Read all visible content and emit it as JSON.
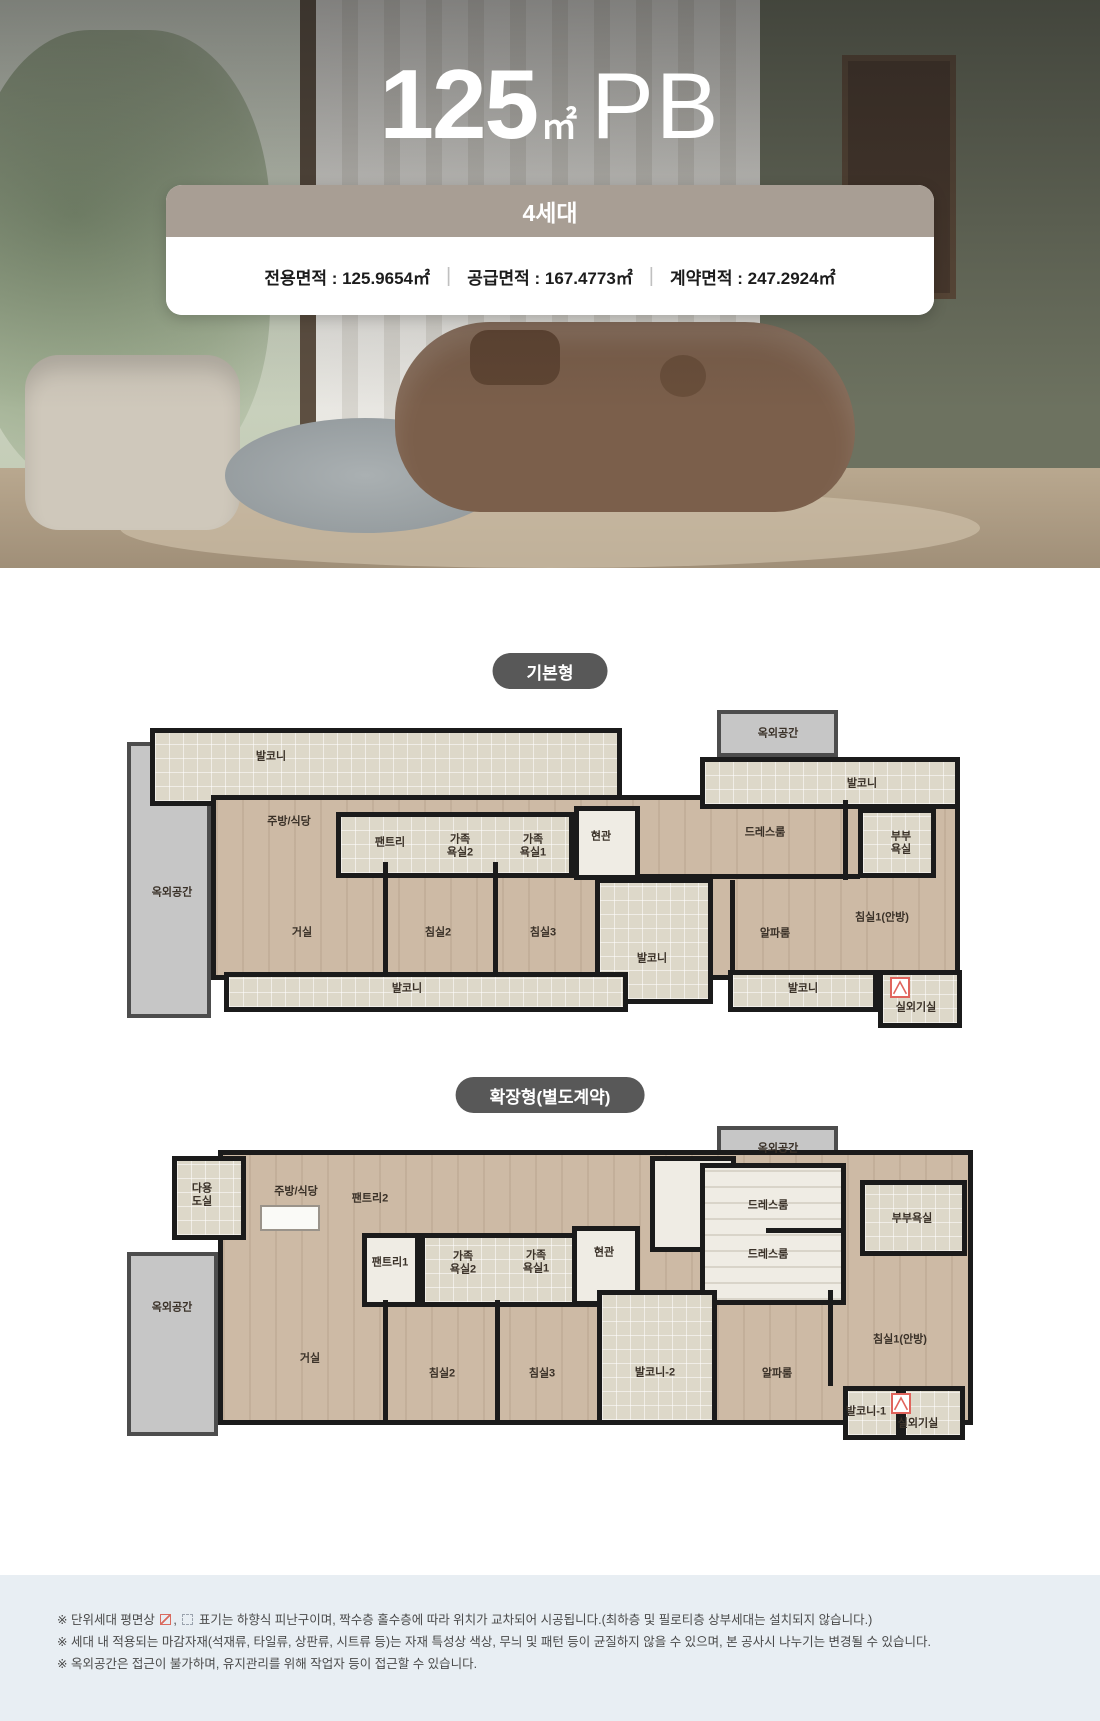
{
  "hero": {
    "title": {
      "number": "125",
      "unit": "㎡",
      "suffix": "PB"
    },
    "badge_label": "4세대",
    "area_info": {
      "separator": "|",
      "items": [
        {
          "label": "전용면적",
          "value": "125.9654㎡",
          "text": "전용면적 : 125.9654㎡"
        },
        {
          "label": "공급면적",
          "value": "167.4773㎡",
          "text": "공급면적 : 167.4773㎡"
        },
        {
          "label": "계약면적",
          "value": "247.2924㎡",
          "text": "계약면적 : 247.2924㎡"
        }
      ]
    }
  },
  "plans": [
    {
      "label": "기본형",
      "rooms": [
        {
          "label": "발코니",
          "x": 271,
          "y": 757
        },
        {
          "label": "주방/식당",
          "x": 289,
          "y": 822
        },
        {
          "label": "팬트리",
          "x": 390,
          "y": 843
        },
        {
          "label": "가족\n욕실2",
          "x": 460,
          "y": 846
        },
        {
          "label": "가족\n욕실1",
          "x": 533,
          "y": 846
        },
        {
          "label": "현관",
          "x": 601,
          "y": 837
        },
        {
          "label": "옥외공간",
          "x": 778,
          "y": 734
        },
        {
          "label": "발코니",
          "x": 862,
          "y": 784
        },
        {
          "label": "드레스룸",
          "x": 765,
          "y": 833
        },
        {
          "label": "부부\n욕실",
          "x": 901,
          "y": 843
        },
        {
          "label": "옥외공간",
          "x": 172,
          "y": 893
        },
        {
          "label": "거실",
          "x": 302,
          "y": 933
        },
        {
          "label": "침실2",
          "x": 438,
          "y": 933
        },
        {
          "label": "침실3",
          "x": 543,
          "y": 933
        },
        {
          "label": "발코니",
          "x": 652,
          "y": 959
        },
        {
          "label": "알파룸",
          "x": 775,
          "y": 934
        },
        {
          "label": "침실1(안방)",
          "x": 882,
          "y": 918
        },
        {
          "label": "발코니",
          "x": 407,
          "y": 989
        },
        {
          "label": "발코니",
          "x": 803,
          "y": 989
        },
        {
          "label": "실외기실",
          "x": 916,
          "y": 1008
        }
      ]
    },
    {
      "label": "확장형(별도계약)",
      "rooms": [
        {
          "label": "옥외공간",
          "x": 778,
          "y": 1149
        },
        {
          "label": "다용\n도실",
          "x": 202,
          "y": 1195
        },
        {
          "label": "주방/식당",
          "x": 296,
          "y": 1192
        },
        {
          "label": "팬트리2",
          "x": 370,
          "y": 1199
        },
        {
          "label": "팬트리1",
          "x": 390,
          "y": 1263
        },
        {
          "label": "가족\n욕실2",
          "x": 463,
          "y": 1263
        },
        {
          "label": "가족\n욕실1",
          "x": 536,
          "y": 1262
        },
        {
          "label": "현관",
          "x": 604,
          "y": 1253
        },
        {
          "label": "드레스룸",
          "x": 768,
          "y": 1206
        },
        {
          "label": "드레스룸",
          "x": 768,
          "y": 1255
        },
        {
          "label": "부부욕실",
          "x": 912,
          "y": 1219
        },
        {
          "label": "옥외공간",
          "x": 172,
          "y": 1308
        },
        {
          "label": "거실",
          "x": 310,
          "y": 1359
        },
        {
          "label": "침실2",
          "x": 442,
          "y": 1374
        },
        {
          "label": "침실3",
          "x": 542,
          "y": 1374
        },
        {
          "label": "발코니-2",
          "x": 655,
          "y": 1373
        },
        {
          "label": "알파룸",
          "x": 777,
          "y": 1374
        },
        {
          "label": "침실1(안방)",
          "x": 900,
          "y": 1340
        },
        {
          "label": "발코니-1",
          "x": 866,
          "y": 1412
        },
        {
          "label": "실외기실",
          "x": 918,
          "y": 1424
        }
      ]
    }
  ],
  "footnotes": {
    "note1_prefix": "※ 단위세대 평면상",
    "note1_comma": ",",
    "note1_suffix": "표기는 하향식 피난구이며, 짝수층 홀수층에 따라 위치가 교차되어 시공됩니다.(최하층 및 필로티층 상부세대는 설치되지 않습니다.)",
    "note2": "※ 세대 내 적용되는 마감자재(석재류, 타일류, 상판류, 시트류 등)는 자재 특성상 색상, 무늬 및 패턴 등이 균질하지 않을 수 있으며, 본 공사시 나누기는 변경될 수 있습니다.",
    "note3": "※ 옥외공간은 접근이 불가하며, 유지관리를 위해 작업자 등이 접근할 수 있습니다."
  },
  "colors": {
    "badge_bg": "#a89e94",
    "pill_bg": "#585858",
    "wall": "#1b1b1b",
    "balcony_tile": "#ddd8c9",
    "room_wood": "#cdbaa5",
    "outdoor_gray": "#c6c6c6",
    "footer_bg": "#e8eef3",
    "escape_hatch_red": "#e0645c"
  }
}
